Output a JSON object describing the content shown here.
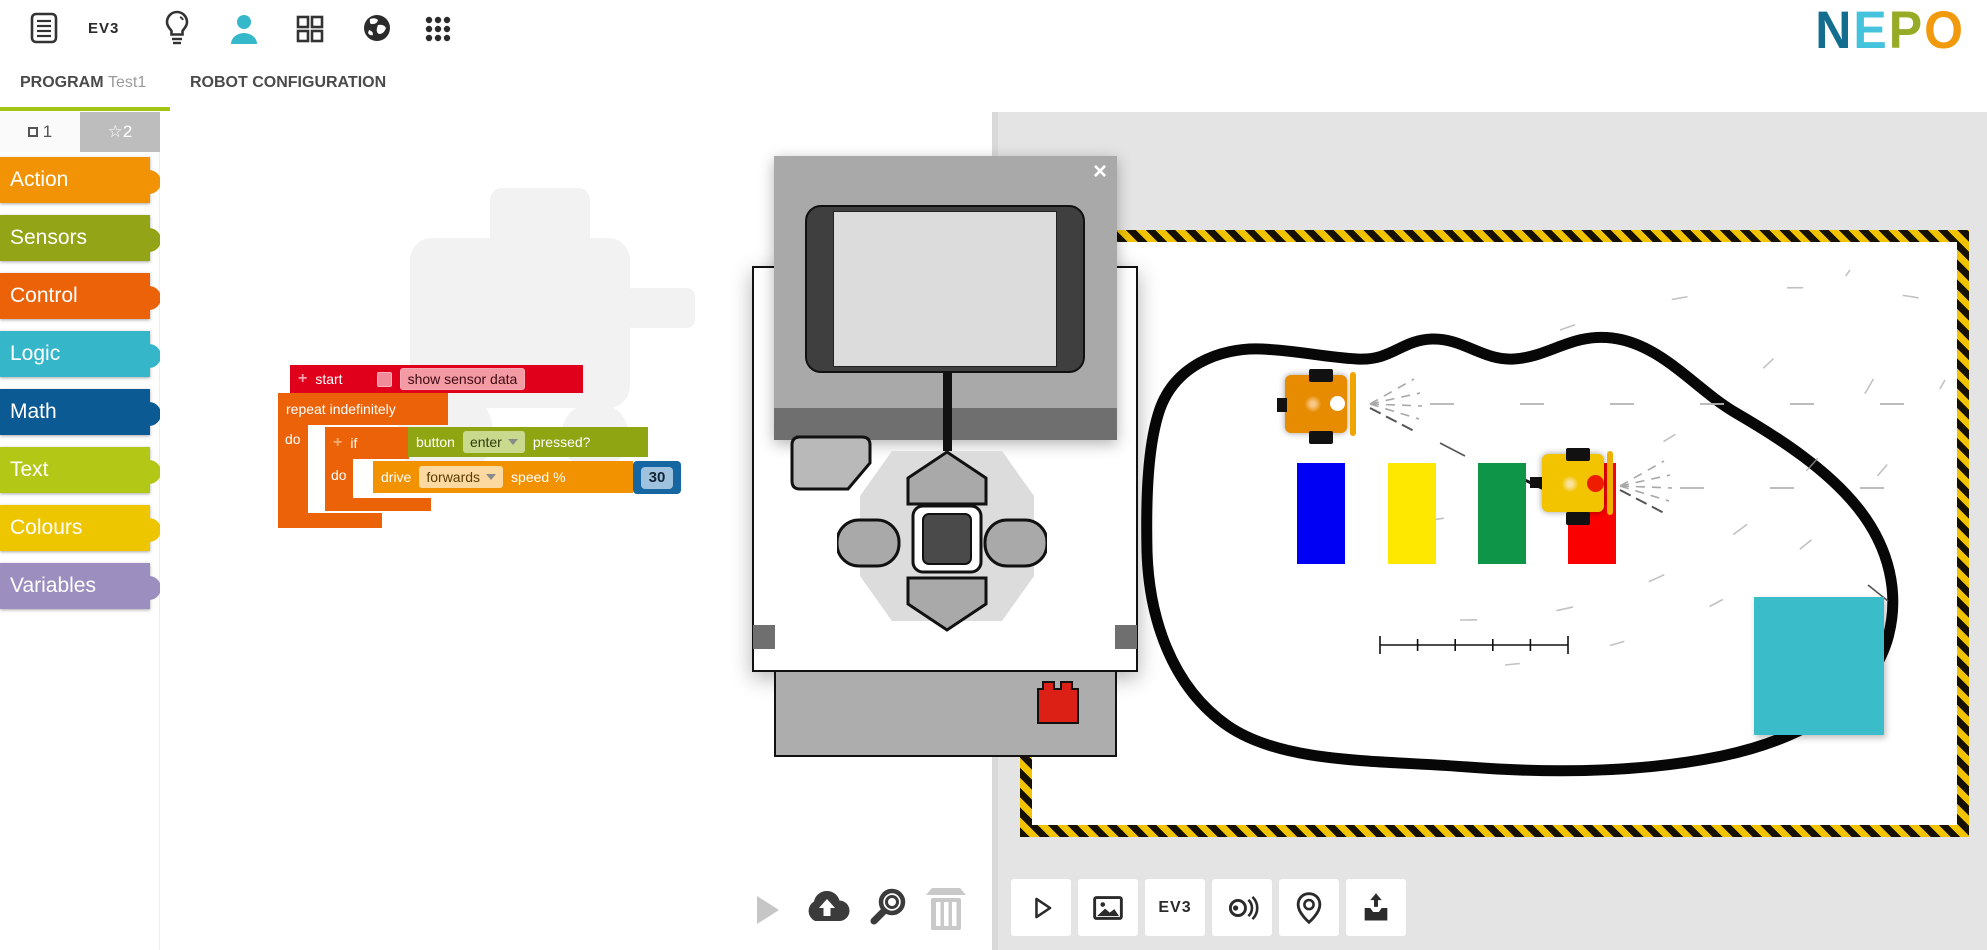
{
  "header": {
    "ev3_label": "EV3",
    "icon_names": [
      "document-icon",
      "ev3-system-label",
      "lightbulb-icon",
      "user-icon",
      "gallery-grid-icon",
      "globe-icon",
      "apps-menu-icon"
    ],
    "logo": {
      "letters": [
        {
          "char": "N",
          "color": "#136d8e"
        },
        {
          "char": "E",
          "color": "#45c3dc"
        },
        {
          "char": "P",
          "color": "#97ab27"
        },
        {
          "char": "O",
          "color": "#f29a0d"
        }
      ]
    }
  },
  "tabs": {
    "program_label": "PROGRAM",
    "program_name": "Test1",
    "config_label": "ROBOT CONFIGURATION",
    "active_underline_color": "#a3c614"
  },
  "palette": {
    "tab1": "1",
    "tab2": "2",
    "tab2_bg": "#bdbdbd",
    "categories": [
      {
        "label": "Action",
        "color": "#f29305"
      },
      {
        "label": "Sensors",
        "color": "#93a416"
      },
      {
        "label": "Control",
        "color": "#eb6209"
      },
      {
        "label": "Logic",
        "color": "#36b6c9"
      },
      {
        "label": "Math",
        "color": "#0c5a94"
      },
      {
        "label": "Text",
        "color": "#b3c716"
      },
      {
        "label": "Colours",
        "color": "#edc600"
      },
      {
        "label": "Variables",
        "color": "#9c8fc0"
      }
    ]
  },
  "program": {
    "start": {
      "plus": "+",
      "label": "start",
      "chip": "show sensor data",
      "color": "#e0001b",
      "chip_color": "#f49aa4",
      "chip_text_color": "#3c0a12",
      "checkbox_color": "#f08b97"
    },
    "repeat": {
      "label": "repeat indefinitely",
      "do_label": "do",
      "color": "#eb6209"
    },
    "if": {
      "plus": "+",
      "label": "if",
      "do_label": "do",
      "color": "#eb6209"
    },
    "button": {
      "label": "button",
      "dropdown": "enter",
      "suffix": "pressed?",
      "color": "#8fa512",
      "chip_color": "#c9d98e",
      "chip_text_color": "#2f3d08"
    },
    "drive": {
      "label": "drive",
      "dropdown": "forwards",
      "suffix": "speed %",
      "color": "#f39200",
      "chip_color": "#fbd9a0",
      "chip_text_color": "#5a3c00"
    },
    "number": {
      "value": "30",
      "color": "#1566a1",
      "inner_color": "#9fc2de"
    }
  },
  "brick_popup": {
    "close_label": "×"
  },
  "workspace_toolbar": {
    "icon_names": [
      "run-play-icon",
      "cloud-upload-icon",
      "zoom-icon",
      "trash-icon"
    ]
  },
  "sim": {
    "toolbar": [
      {
        "name": "sim-play-button"
      },
      {
        "name": "sim-background-button"
      },
      {
        "name": "sim-robot-button",
        "label": "EV3"
      },
      {
        "name": "sim-sensor-values-button"
      },
      {
        "name": "sim-pose-button"
      },
      {
        "name": "sim-import-button"
      }
    ],
    "colors": {
      "blue_box": "#0000f5",
      "yellow_box": "#ffe800",
      "green_box": "#0e9547",
      "red_box": "#fb0000",
      "teal_obstacle": "#3abcc9",
      "robot1_body": "#e78c00",
      "robot2_body": "#f2c400"
    }
  }
}
